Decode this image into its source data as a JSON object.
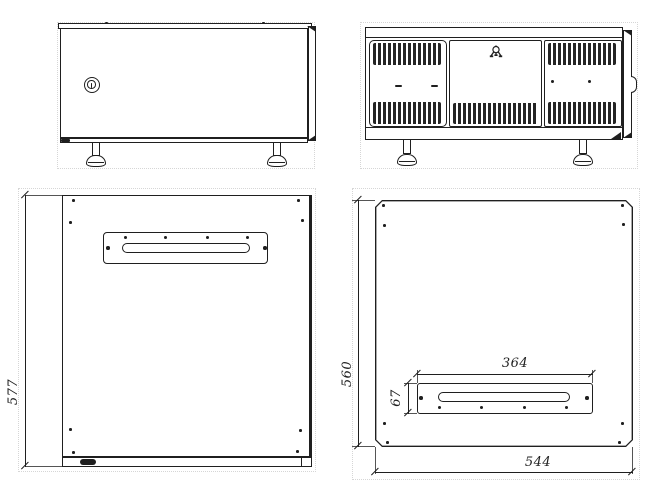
{
  "drawing": {
    "background_color": "#ffffff",
    "line_color": "#1f1f1f",
    "icons": {
      "lock": "cam-lock-keyhole",
      "ground": "earth-ground-symbol"
    },
    "dimension_labels": {
      "side_height": "577",
      "bottom_view_height": "560",
      "bottom_view_width": "544",
      "gland_plate_width": "364",
      "gland_plate_height": "67"
    }
  }
}
